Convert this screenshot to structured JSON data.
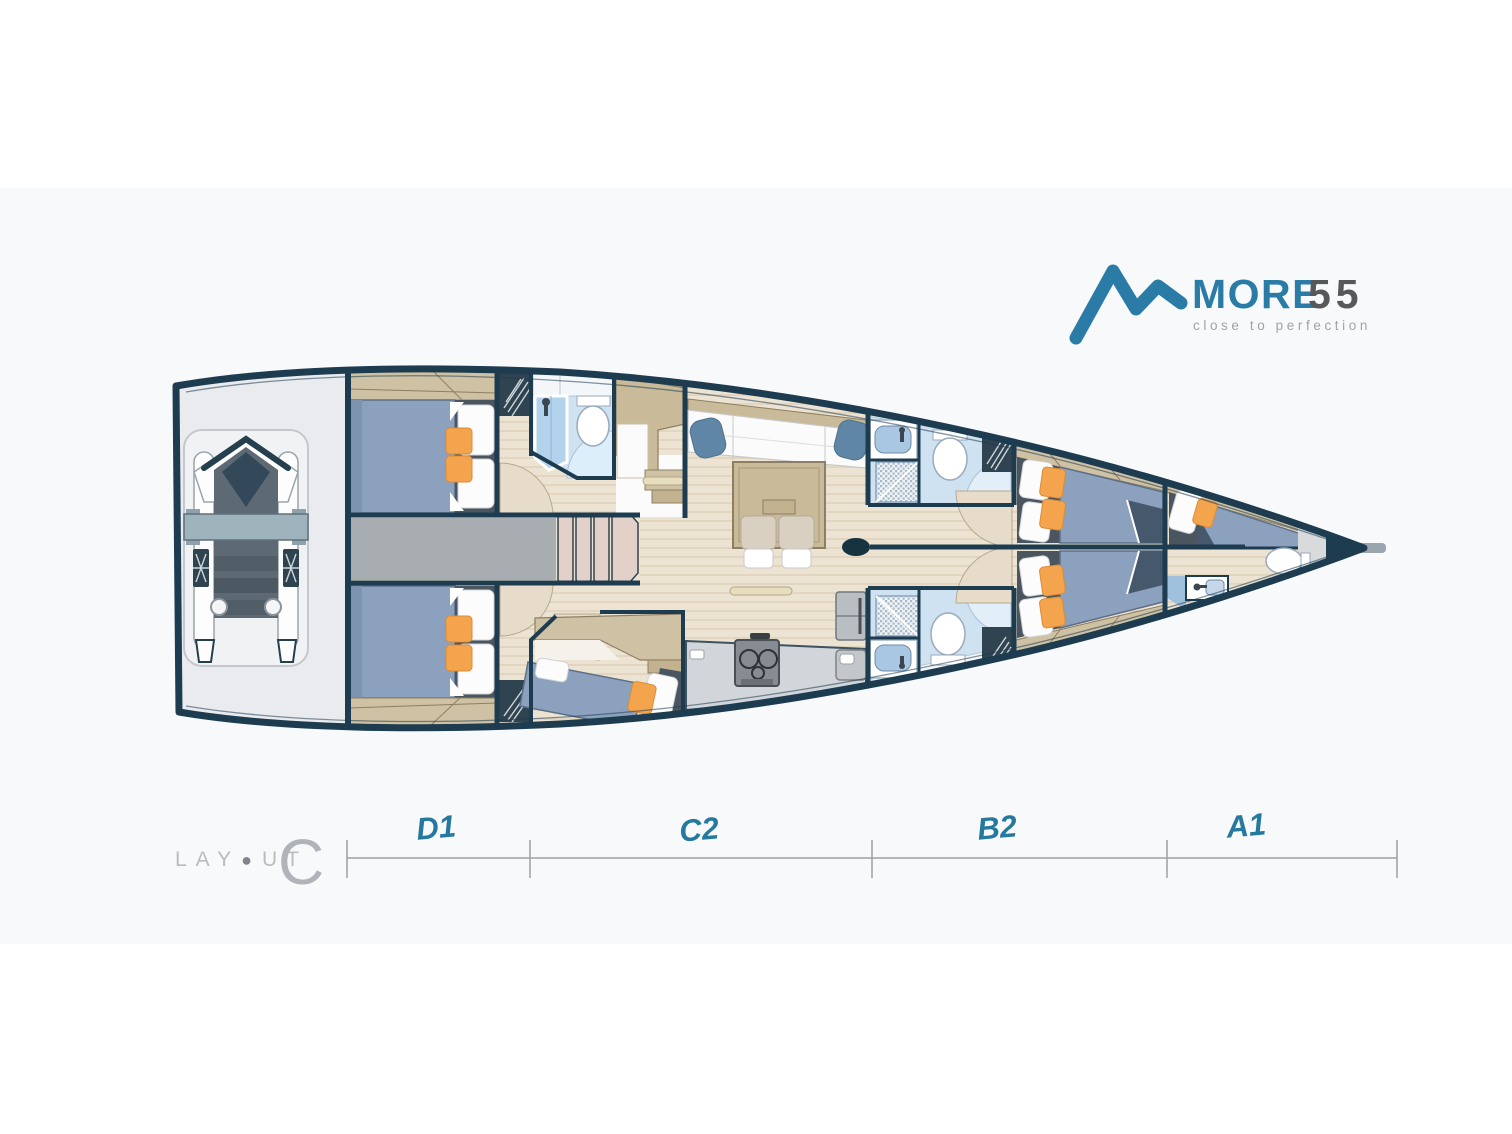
{
  "logo": {
    "brand": "MORE",
    "model": "55",
    "tagline": "close to perfection",
    "accent_color": "#2a7ca6",
    "model_color": "#57585a"
  },
  "footer": {
    "layout_word_pre": "LAY",
    "layout_o": "●",
    "layout_word_post": "UT",
    "layout_variant": "C"
  },
  "sections": [
    {
      "label": "D1"
    },
    {
      "label": "C2"
    },
    {
      "label": "B2"
    },
    {
      "label": "A1"
    }
  ],
  "colors": {
    "hull_navy": "#1d3c50",
    "section_label_teal": "#26799e",
    "wood_floor": "#ede3d2",
    "cabinet_tan": "#cfc1a3",
    "mattress_blue": "#8ba1bd",
    "orange_cushion": "#f4a44c",
    "bathroom_blue": "#cfe2f2",
    "corridor_gray": "#a8adb2",
    "dimension_gray": "#9aa1a7",
    "background_band": "#f8f9fb"
  }
}
